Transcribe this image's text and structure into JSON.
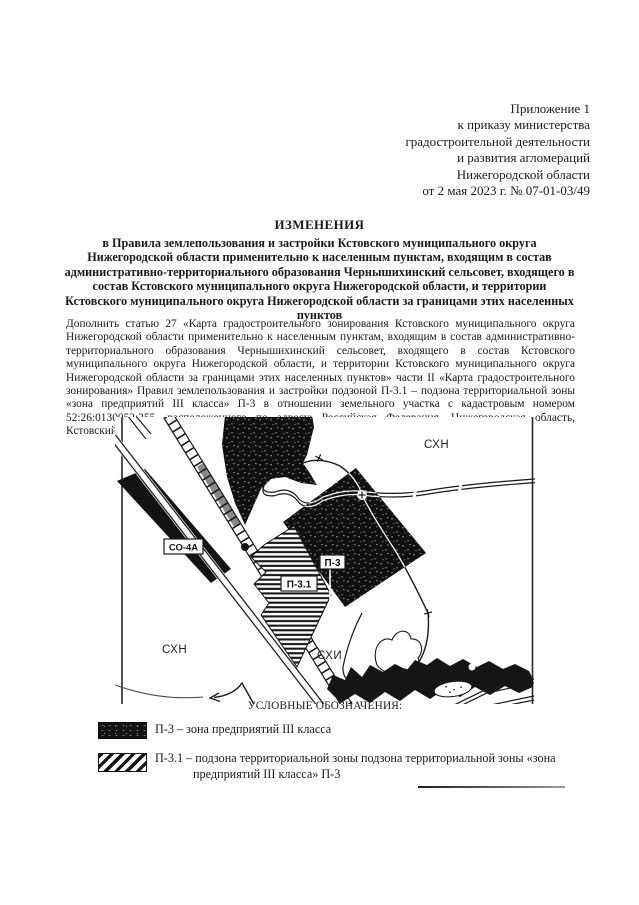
{
  "document": {
    "annex": {
      "lines": [
        "Приложение 1",
        "к приказу министерства",
        "градостроительной деятельности",
        "и развития агломераций",
        "Нижегородской области",
        "от 2 мая 2023 г. № 07-01-03/49"
      ]
    },
    "title": "ИЗМЕНЕНИЯ",
    "subtitle": "в Правила землепользования и застройки Кстовского муниципального округа Нижегородской области применительно к населенным пунктам, входящим в состав административно-территориального образования Чернышихинский сельсовет, входящего в состав Кстовского муниципального округа Нижегородской области, и территории Кстовского муниципального округа Нижегородской области за границами этих населенных пунктов",
    "body": "Дополнить статью 27 «Карта градостроительного зонирования Кстовского муниципального округа Нижегородской области применительно к населенным пунктам, входящим в состав административно-территориального образования Чернышихинский сельсовет, входящего в состав Кстовского муниципального округа Нижегородской области, и территории Кстовского муниципального округа Нижегородской области за границами этих населенных пунктов» части II «Карта градостроительного зонирования» Правил землепользования и застройки подзоной П-3.1 – подзона территориальной зоны «зона предприятий III класса» П-3 в отношении земельного участка с кадастровым номером 52:26:0130052:255, расположенного по адресу: Российская Федерация, Нижегородская область, Кстовский район, в следующих границах:"
  },
  "map": {
    "zone_labels": {
      "sxn_top_right": "СХН",
      "sxn_bottom_left": "СХН",
      "sxi": "СХИ"
    },
    "boxed_labels": {
      "so_4a": "СО-4А",
      "p3": "П-3",
      "p3_1": "П-3.1"
    }
  },
  "legend": {
    "heading": "УСЛОВНЫЕ ОБОЗНАЧЕНИЯ:",
    "items": [
      {
        "swatch": "speckled-black",
        "label": "П-3 – зона предприятий III класса"
      },
      {
        "swatch": "diagonal-hatch",
        "label": "П-3.1 – подзона территориальной зоны подзона территориальной зоны «зона предприятий III класса» П-3"
      }
    ]
  },
  "colors": {
    "ink": "#1a1a1a",
    "paper": "#ffffff"
  }
}
